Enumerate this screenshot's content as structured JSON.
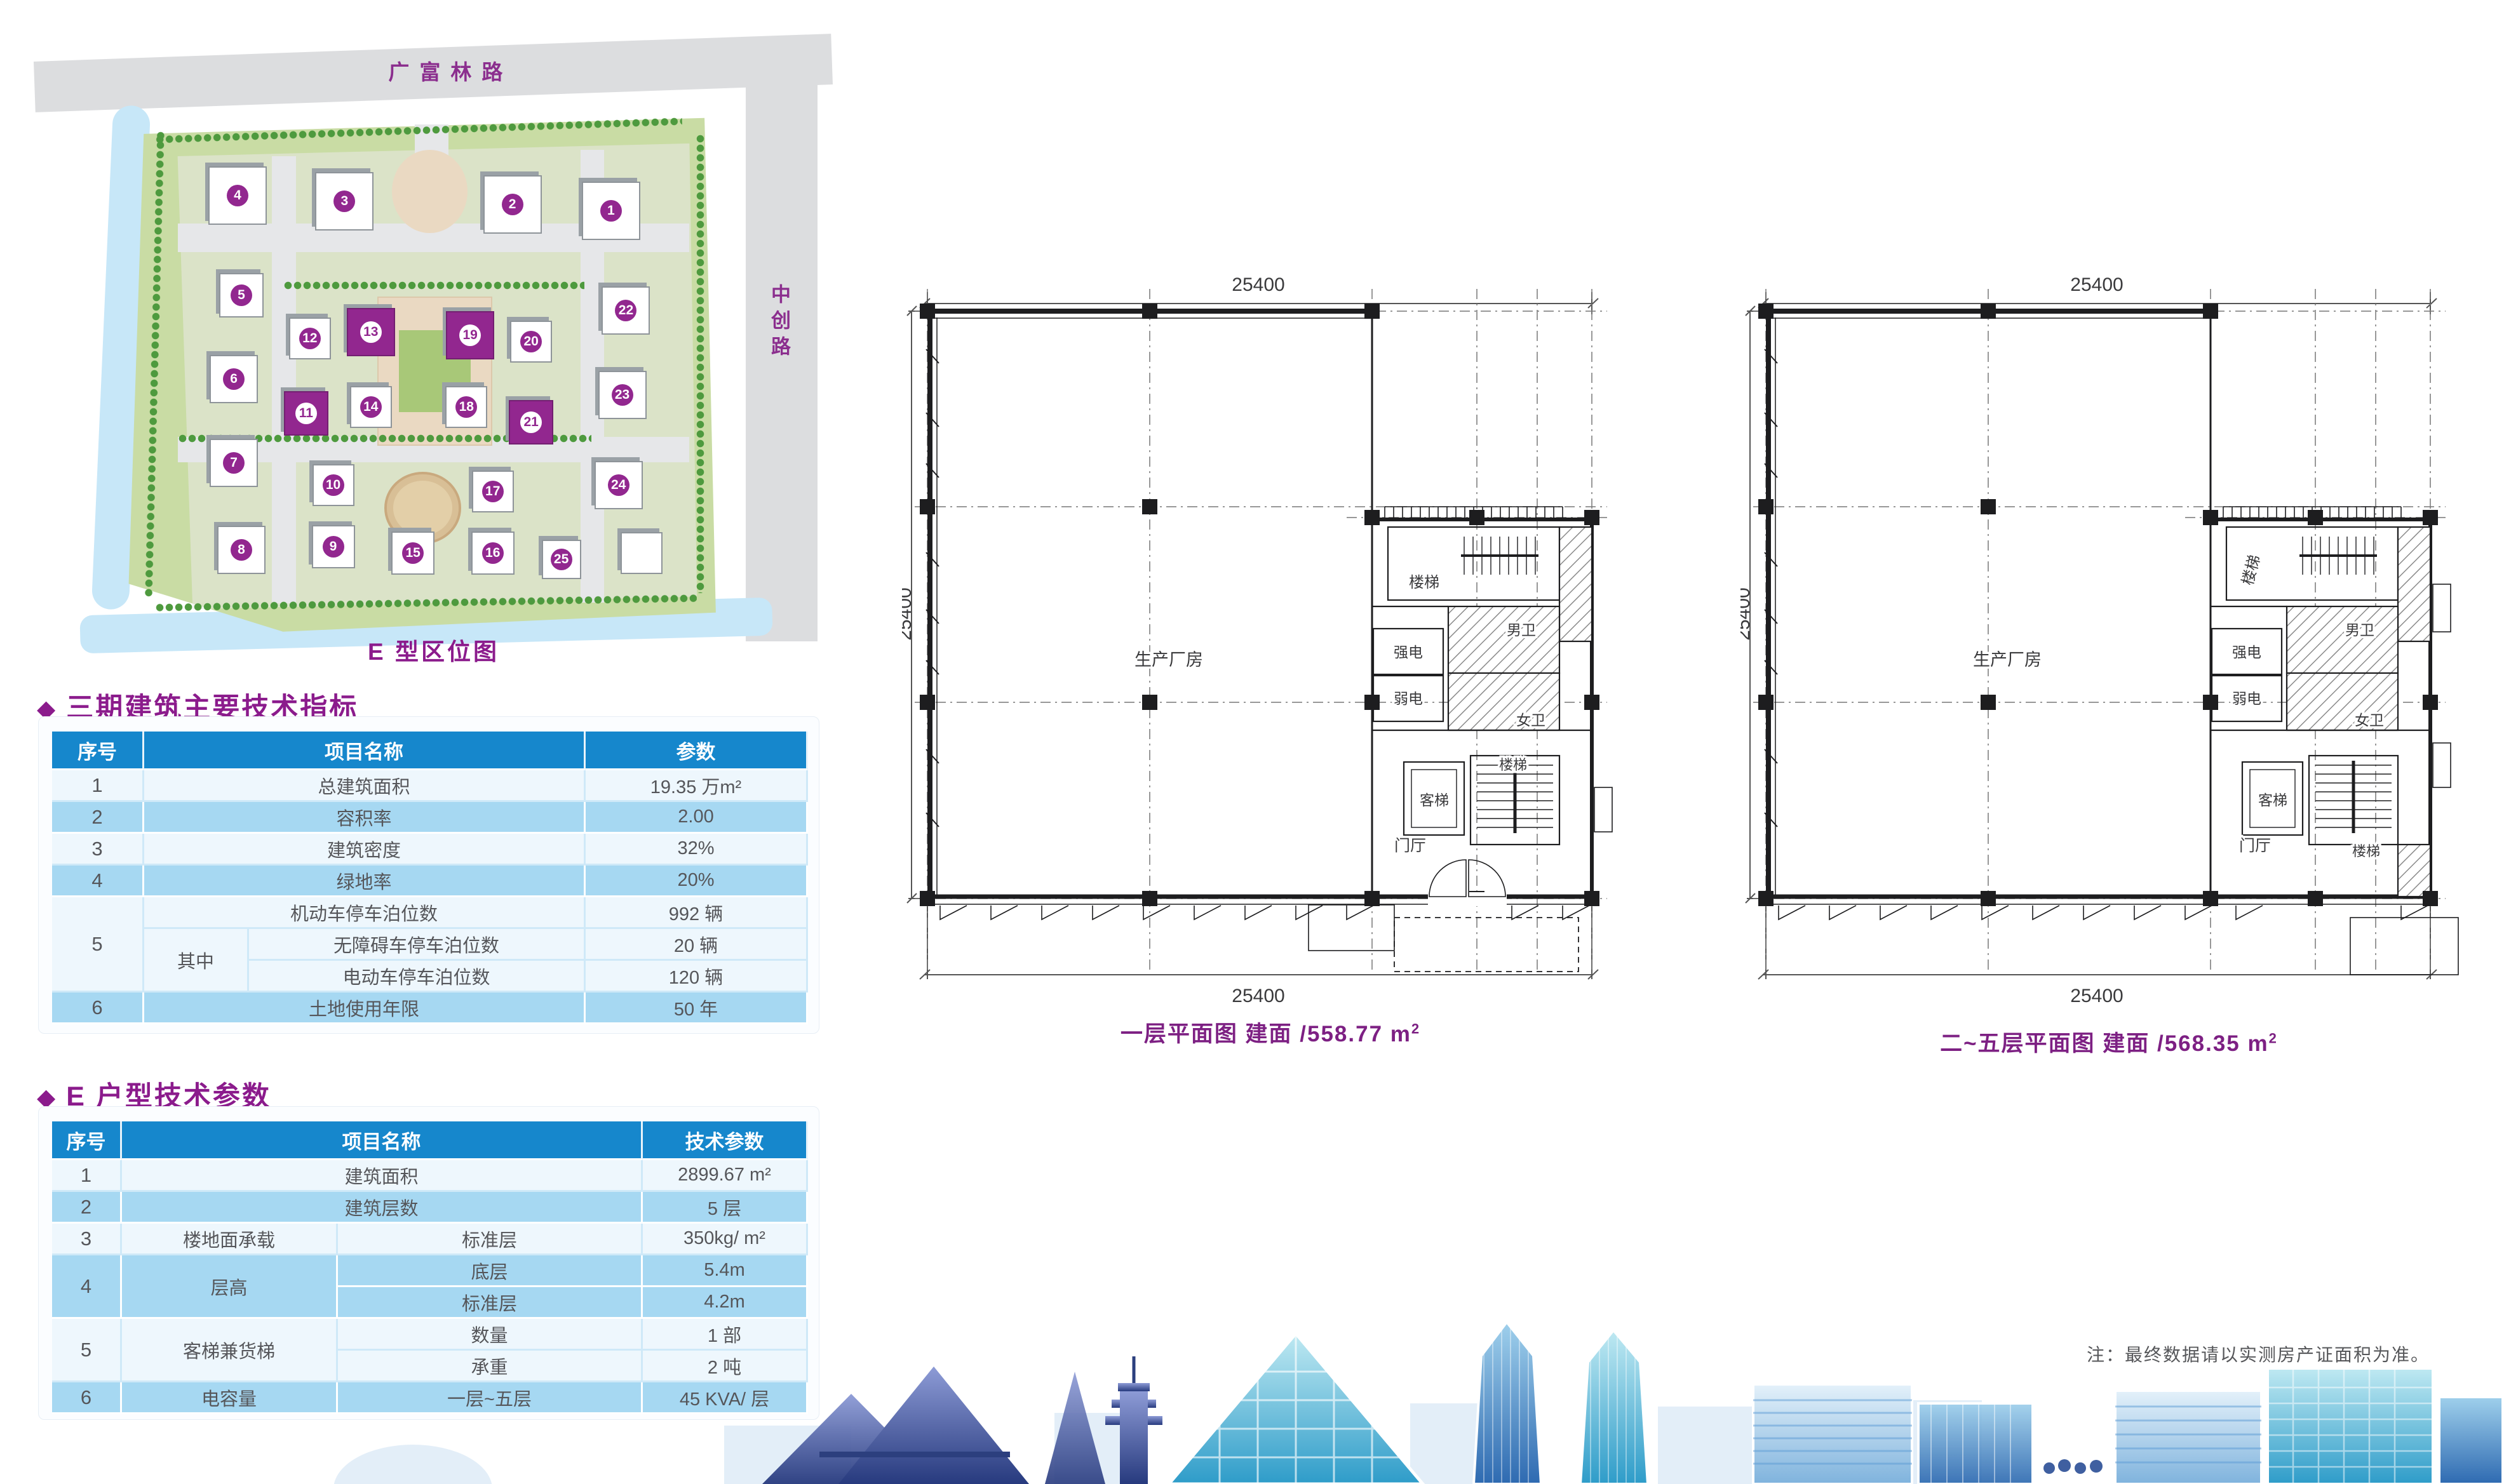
{
  "map": {
    "road_top": "广富林路",
    "road_right": "中创路",
    "caption": "E 型区位图",
    "highlight_color": "#92278F",
    "buildings": [
      {
        "n": "4",
        "x": 23.8,
        "y": 26.0,
        "s": 88
      },
      {
        "n": "3",
        "x": 38.0,
        "y": 26.9,
        "s": 88
      },
      {
        "n": "2",
        "x": 60.3,
        "y": 27.4,
        "s": 88
      },
      {
        "n": "1",
        "x": 73.4,
        "y": 28.4,
        "s": 88
      },
      {
        "n": "5",
        "x": 24.3,
        "y": 41.6,
        "s": 66
      },
      {
        "n": "22",
        "x": 75.4,
        "y": 44.0,
        "s": 72
      },
      {
        "n": "12",
        "x": 33.4,
        "y": 48.4,
        "s": 62
      },
      {
        "n": "13",
        "x": 41.5,
        "y": 47.4,
        "s": 72,
        "hl": true
      },
      {
        "n": "19",
        "x": 54.7,
        "y": 47.9,
        "s": 72,
        "hl": true
      },
      {
        "n": "20",
        "x": 62.8,
        "y": 48.9,
        "s": 62
      },
      {
        "n": "6",
        "x": 23.3,
        "y": 54.7,
        "s": 72
      },
      {
        "n": "23",
        "x": 74.9,
        "y": 57.2,
        "s": 72
      },
      {
        "n": "11",
        "x": 32.9,
        "y": 60.1,
        "s": 66,
        "hl": true
      },
      {
        "n": "14",
        "x": 41.5,
        "y": 59.1,
        "s": 62
      },
      {
        "n": "18",
        "x": 54.2,
        "y": 59.1,
        "s": 62
      },
      {
        "n": "21",
        "x": 62.8,
        "y": 61.5,
        "s": 66,
        "hl": true
      },
      {
        "n": "7",
        "x": 23.3,
        "y": 67.9,
        "s": 72
      },
      {
        "n": "10",
        "x": 36.5,
        "y": 71.3,
        "s": 62
      },
      {
        "n": "17",
        "x": 57.7,
        "y": 72.3,
        "s": 62
      },
      {
        "n": "24",
        "x": 74.4,
        "y": 71.3,
        "s": 72
      },
      {
        "n": "8",
        "x": 24.3,
        "y": 81.5,
        "s": 72
      },
      {
        "n": "9",
        "x": 36.5,
        "y": 81.0,
        "s": 64
      },
      {
        "n": "15",
        "x": 47.1,
        "y": 82.0,
        "s": 64
      },
      {
        "n": "16",
        "x": 57.7,
        "y": 82.0,
        "s": 64
      },
      {
        "n": "25",
        "x": 66.8,
        "y": 83.0,
        "s": 58
      },
      {
        "n": "",
        "x": 77.5,
        "y": 82.0,
        "s": 62
      }
    ]
  },
  "table1": {
    "bullet": "◆",
    "title": "三期建筑主要技术指标",
    "col_no": "序号",
    "col_name": "项目名称",
    "col_param": "参数",
    "r1": {
      "no": "1",
      "name": "总建筑面积",
      "value": "19.35 万m²"
    },
    "r2": {
      "no": "2",
      "name": "容积率",
      "value": "2.00"
    },
    "r3": {
      "no": "3",
      "name": "建筑密度",
      "value": "32%"
    },
    "r4": {
      "no": "4",
      "name": "绿地率",
      "value": "20%"
    },
    "r5": {
      "no": "5",
      "among": "其中",
      "a_name": "机动车停车泊位数",
      "a_value": "992 辆",
      "b_name": "无障碍车停车泊位数",
      "b_value": "20 辆",
      "c_name": "电动车停车泊位数",
      "c_value": "120 辆"
    },
    "r6": {
      "no": "6",
      "name": "土地使用年限",
      "value": "50 年"
    }
  },
  "table2": {
    "bullet": "◆",
    "title": "E 户型技术参数",
    "col_no": "序号",
    "col_name": "项目名称",
    "col_param": "技术参数",
    "r1": {
      "no": "1",
      "name": "建筑面积",
      "value": "2899.67 m²"
    },
    "r2": {
      "no": "2",
      "name": "建筑层数",
      "value": "5 层"
    },
    "r3": {
      "no": "3",
      "cat": "楼地面承载",
      "sub": "标准层",
      "value": "350kg/ m²"
    },
    "r4": {
      "no": "4",
      "cat": "层高",
      "a_sub": "底层",
      "a_value": "5.4m",
      "b_sub": "标准层",
      "b_value": "4.2m"
    },
    "r5": {
      "no": "5",
      "cat": "客梯兼货梯",
      "a_sub": "数量",
      "a_value": "1 部",
      "b_sub": "承重",
      "b_value": "2 吨"
    },
    "r6": {
      "no": "6",
      "cat": "电容量",
      "sub": "一层~五层",
      "value": "45 KVA/ 层"
    }
  },
  "plans": [
    {
      "dim": "25400",
      "caption": "一层平面图 建面 /558.77 m",
      "caption_sup": "2",
      "rooms": {
        "workshop": "生产厂房",
        "stair_top": "楼梯",
        "stair_bottom": "楼梯",
        "strong": "强电",
        "weak": "弱电",
        "men": "男卫",
        "women": "女卫",
        "lift": "客梯",
        "lobby": "门厅"
      }
    },
    {
      "dim": "25400",
      "caption": "二~五层平面图 建面 /568.35 m",
      "caption_sup": "2",
      "rooms": {
        "workshop": "生产厂房",
        "stair_top": "楼梯",
        "stair_bottom": "楼梯",
        "strong": "强电",
        "weak": "弱电",
        "men": "男卫",
        "women": "女卫",
        "lift": "客梯",
        "lobby": "门厅"
      }
    }
  ],
  "note": "注：最终数据请以实测房产证面积为准。"
}
